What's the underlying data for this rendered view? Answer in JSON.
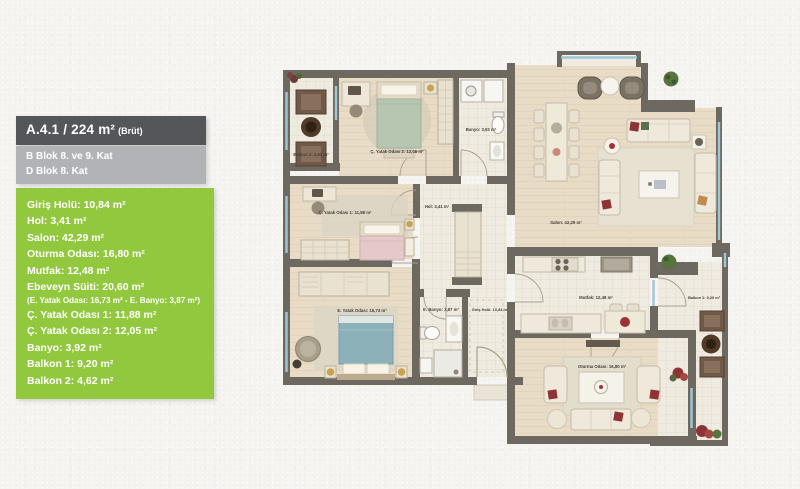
{
  "panel": {
    "title": "A.4.1 / 224 m²",
    "title_suffix": "(Brüt)",
    "block_line_1": "B Blok 8. ve 9. Kat",
    "block_line_2": "D Blok 8. Kat",
    "rooms": [
      "Giriş Holü: 10,84 m²",
      "Hol: 3,41 m²",
      "Salon: 42,29 m²",
      "Oturma Odası: 16,80 m²",
      "Mutfak: 12,48 m²",
      "Ebeveyn Süiti: 20,60 m²",
      "Ç. Yatak Odası 1: 11,88 m²",
      "Ç. Yatak Odası 2: 12,05 m²",
      "Banyo: 3,92 m²",
      "Balkon 1: 9,20 m²",
      "Balkon 2: 4,62 m²"
    ],
    "note": "(E. Yatak Odası: 16,73 m² - E. Banyo: 3,87 m²)",
    "colors": {
      "header_bg": "#55565A",
      "subheader_bg": "#B1B3B6",
      "list_bg": "#92C83E"
    }
  },
  "plan": {
    "colors": {
      "wall": "#6E6960",
      "wood_floor": "#E8DCC6",
      "tile_floor": "#F0EBE1",
      "window": "#9EC7D8"
    },
    "labels": {
      "balkon2": "Balkon 2: 4,62 m²",
      "cocuk2": "Ç. Yatak Odası 2: 12,05 m²",
      "banyo": "Banyo: 3,92 m²",
      "salon": "Salon: 42,29 m²",
      "cocuk1": "Ç. Yatak Odası 1: 11,88 m²",
      "hol": "Hol: 3,41 m²",
      "ebeveyn": "E. Yatak Odası: 16,73 m²",
      "ebanyo": "E. Banyo: 3,87 m²",
      "giris": "Giriş Holü: 10,84 m²",
      "mutfak": "Mutfak: 12,48 m²",
      "oturma": "Oturma Odası: 16,80 m²",
      "balkon1": "Balkon 1: 9,20 m²"
    }
  }
}
